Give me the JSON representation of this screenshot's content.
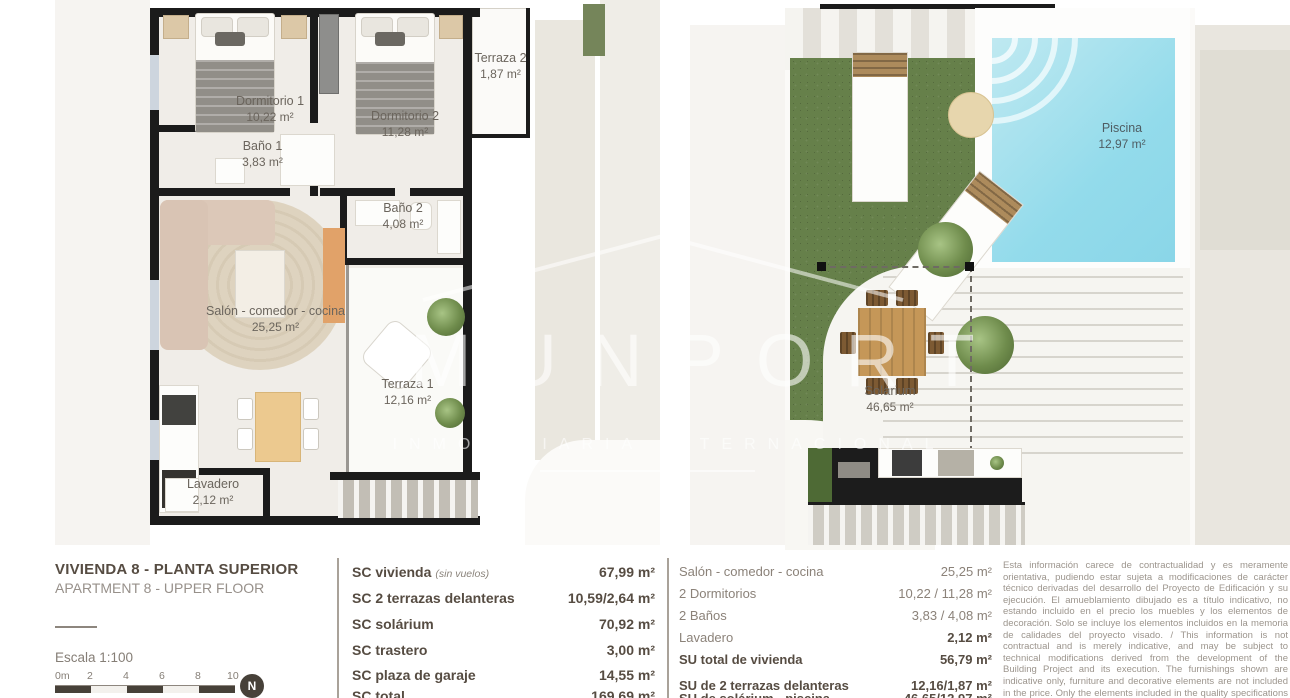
{
  "watermark": {
    "brand": "MUNPORT",
    "tagline": "INMOBILIARIA INTERNACIONAL"
  },
  "title_block": {
    "title": "VIVIENDA 8 - PLANTA SUPERIOR",
    "subtitle": "APARTMENT 8 - UPPER FLOOR",
    "scale_label": "Escala  1:100",
    "scale_ticks": [
      "0m",
      "2",
      "4",
      "6",
      "8",
      "10"
    ],
    "compass": "N"
  },
  "plans": {
    "left": {
      "rooms": [
        {
          "name": "Dormitorio 1",
          "area": "10,22 m²"
        },
        {
          "name": "Dormitorio 2",
          "area": "11,28 m²"
        },
        {
          "name": "Terraza 2",
          "area": "1,87 m²"
        },
        {
          "name": "Baño 1",
          "area": "3,83 m²"
        },
        {
          "name": "Baño 2",
          "area": "4,08 m²"
        },
        {
          "name": "Salón - comedor - cocina",
          "area": "25,25 m²"
        },
        {
          "name": "Terraza 1",
          "area": "12,16 m²"
        },
        {
          "name": "Lavadero",
          "area": "2,12 m²"
        }
      ]
    },
    "right": {
      "rooms": [
        {
          "name": "Piscina",
          "area": "12,97 m²"
        },
        {
          "name": "Solárium",
          "area": "46,65 m²"
        }
      ]
    }
  },
  "sc_table": {
    "rows": [
      {
        "label": "SC vivienda",
        "note": "(sin vuelos)",
        "value": "67,99 m²"
      },
      {
        "label": "SC 2 terrazas delanteras",
        "note": "",
        "value": "10,59/2,64 m²"
      },
      {
        "label": "SC solárium",
        "note": "",
        "value": "70,92 m²"
      },
      {
        "label": "SC trastero",
        "note": "",
        "value": "3,00 m²"
      },
      {
        "label": "SC plaza de garaje",
        "note": "",
        "value": "14,55 m²"
      }
    ],
    "total_label": "SC total",
    "total_value": "169,69 m²"
  },
  "su_table": {
    "rows": [
      {
        "label": "Salón - comedor - cocina",
        "value": "25,25 m²"
      },
      {
        "label": "2 Dormitorios",
        "value": "10,22 / 11,28 m²"
      },
      {
        "label": "2 Baños",
        "value": "3,83 / 4,08 m²"
      },
      {
        "label": "Lavadero",
        "value": "2,12 m²"
      },
      {
        "label": "SU total de vivienda",
        "value": "56,79 m²"
      }
    ],
    "extras": [
      {
        "label": "SU de 2 terrazas delanteras",
        "value": "12,16/1,87 m²"
      },
      {
        "label": "SU de solárium - piscina",
        "value": "46,65/12,97 m²"
      }
    ]
  },
  "disclaimer": "Esta información carece de contractualidad y es meramente orientativa, pudiendo estar sujeta a modificaciones de carácter técnico derivadas del desarrollo del Proyecto de Edificación y su ejecución. El amueblamiento dibujado es a título indicativo, no estando incluido en el precio los muebles y los elementos de decoración. Solo se incluye los elementos incluidos en la memoria de calidades del proyecto visado. / This information is not contractual and is merely indicative, and may be subject to technical modifications derived from the development of the Building Project and its execution. The furnishings shown are indicative only, furniture and decorative elements are not included in the price. Only the elements included in the quality specifications of the approved project are included.",
  "colors": {
    "wall": "#1b1b1b",
    "grass": "#66804a",
    "pool_water": "#93dbeb",
    "wood": "#c59758",
    "title_text": "#564c42",
    "muted_text": "#97908a",
    "disclaimer_text": "#9c958d"
  }
}
